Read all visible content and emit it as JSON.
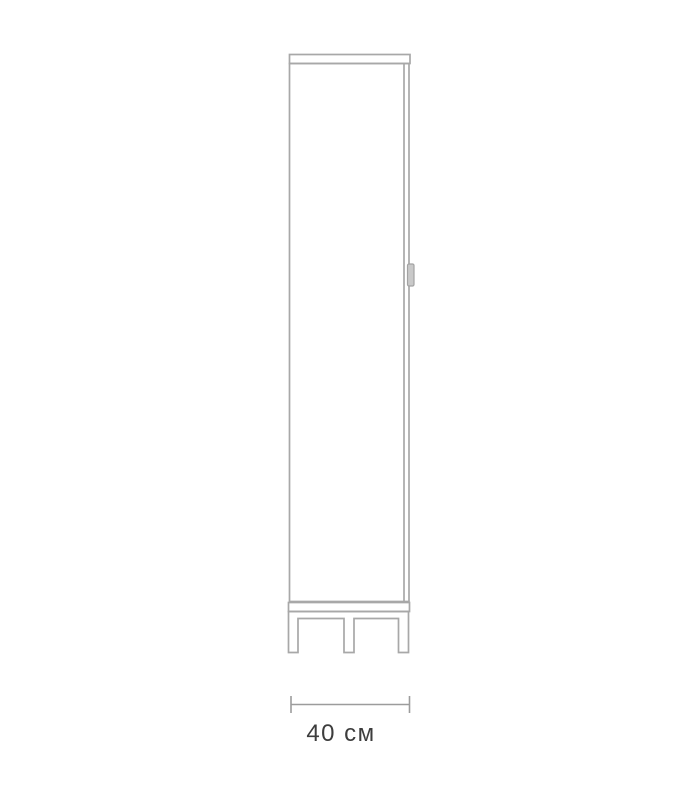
{
  "figure": {
    "type": "furniture-line-drawing",
    "subject": "tall single-door cabinet on leg frame, front view"
  },
  "dimension": {
    "label": "40 см",
    "value": 40,
    "unit": "см"
  },
  "colors": {
    "line": "#a8a8a8",
    "dim_line": "#9c9c9c",
    "text": "#3d3d3d",
    "handle_fill": "#c9c9c9",
    "handle_stroke": "#a3a3a3",
    "background": "#ffffff"
  }
}
